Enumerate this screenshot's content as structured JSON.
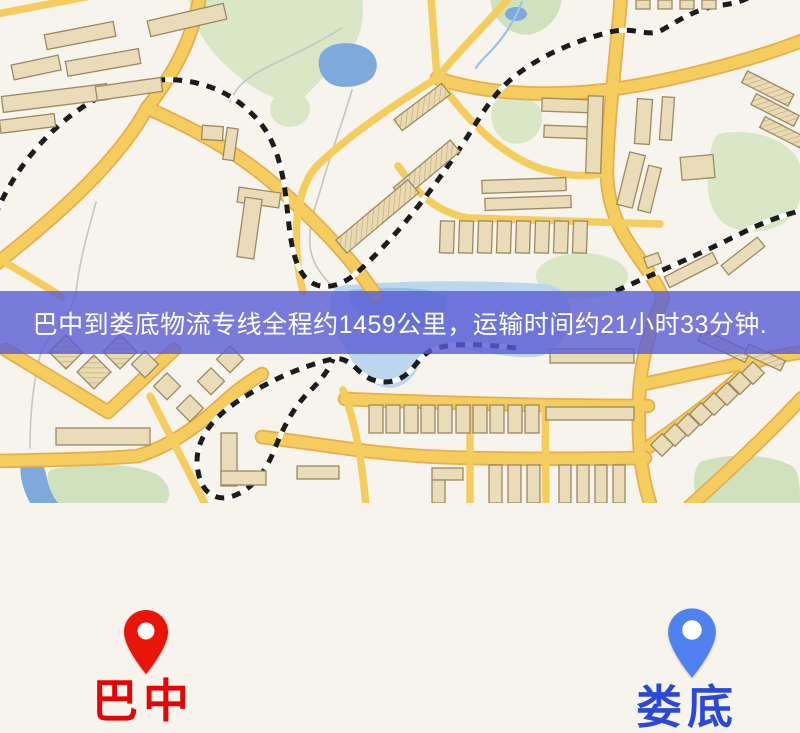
{
  "map": {
    "markers": [
      {
        "id": "bazhong",
        "label": "巴中",
        "pin_color": "#e81508",
        "label_color": "#e60205"
      },
      {
        "id": "loudi",
        "label": "娄底",
        "pin_color": "#4f82ee",
        "label_color": "#2b49d8"
      }
    ],
    "banner": {
      "text": "巴中到娄底物流专线全程约1459公里，运输时间约21小时33分钟.",
      "bg_rgba": "rgba(89,93,214,0.80)",
      "text_color": "#ffffff"
    },
    "palette": {
      "bg": "#f7f3ed",
      "road": "#f5cd5e",
      "road-casing": "#e8ad4e",
      "park": "#d9e7c6",
      "park2": "#cfe2bd",
      "water": "#7ea9dd",
      "water-light": "#bcd6ee",
      "building": "#eadcb8",
      "building-outline": "#9b8a63",
      "railway": "#1c1c1c",
      "stream": "#c2c8c0"
    }
  }
}
